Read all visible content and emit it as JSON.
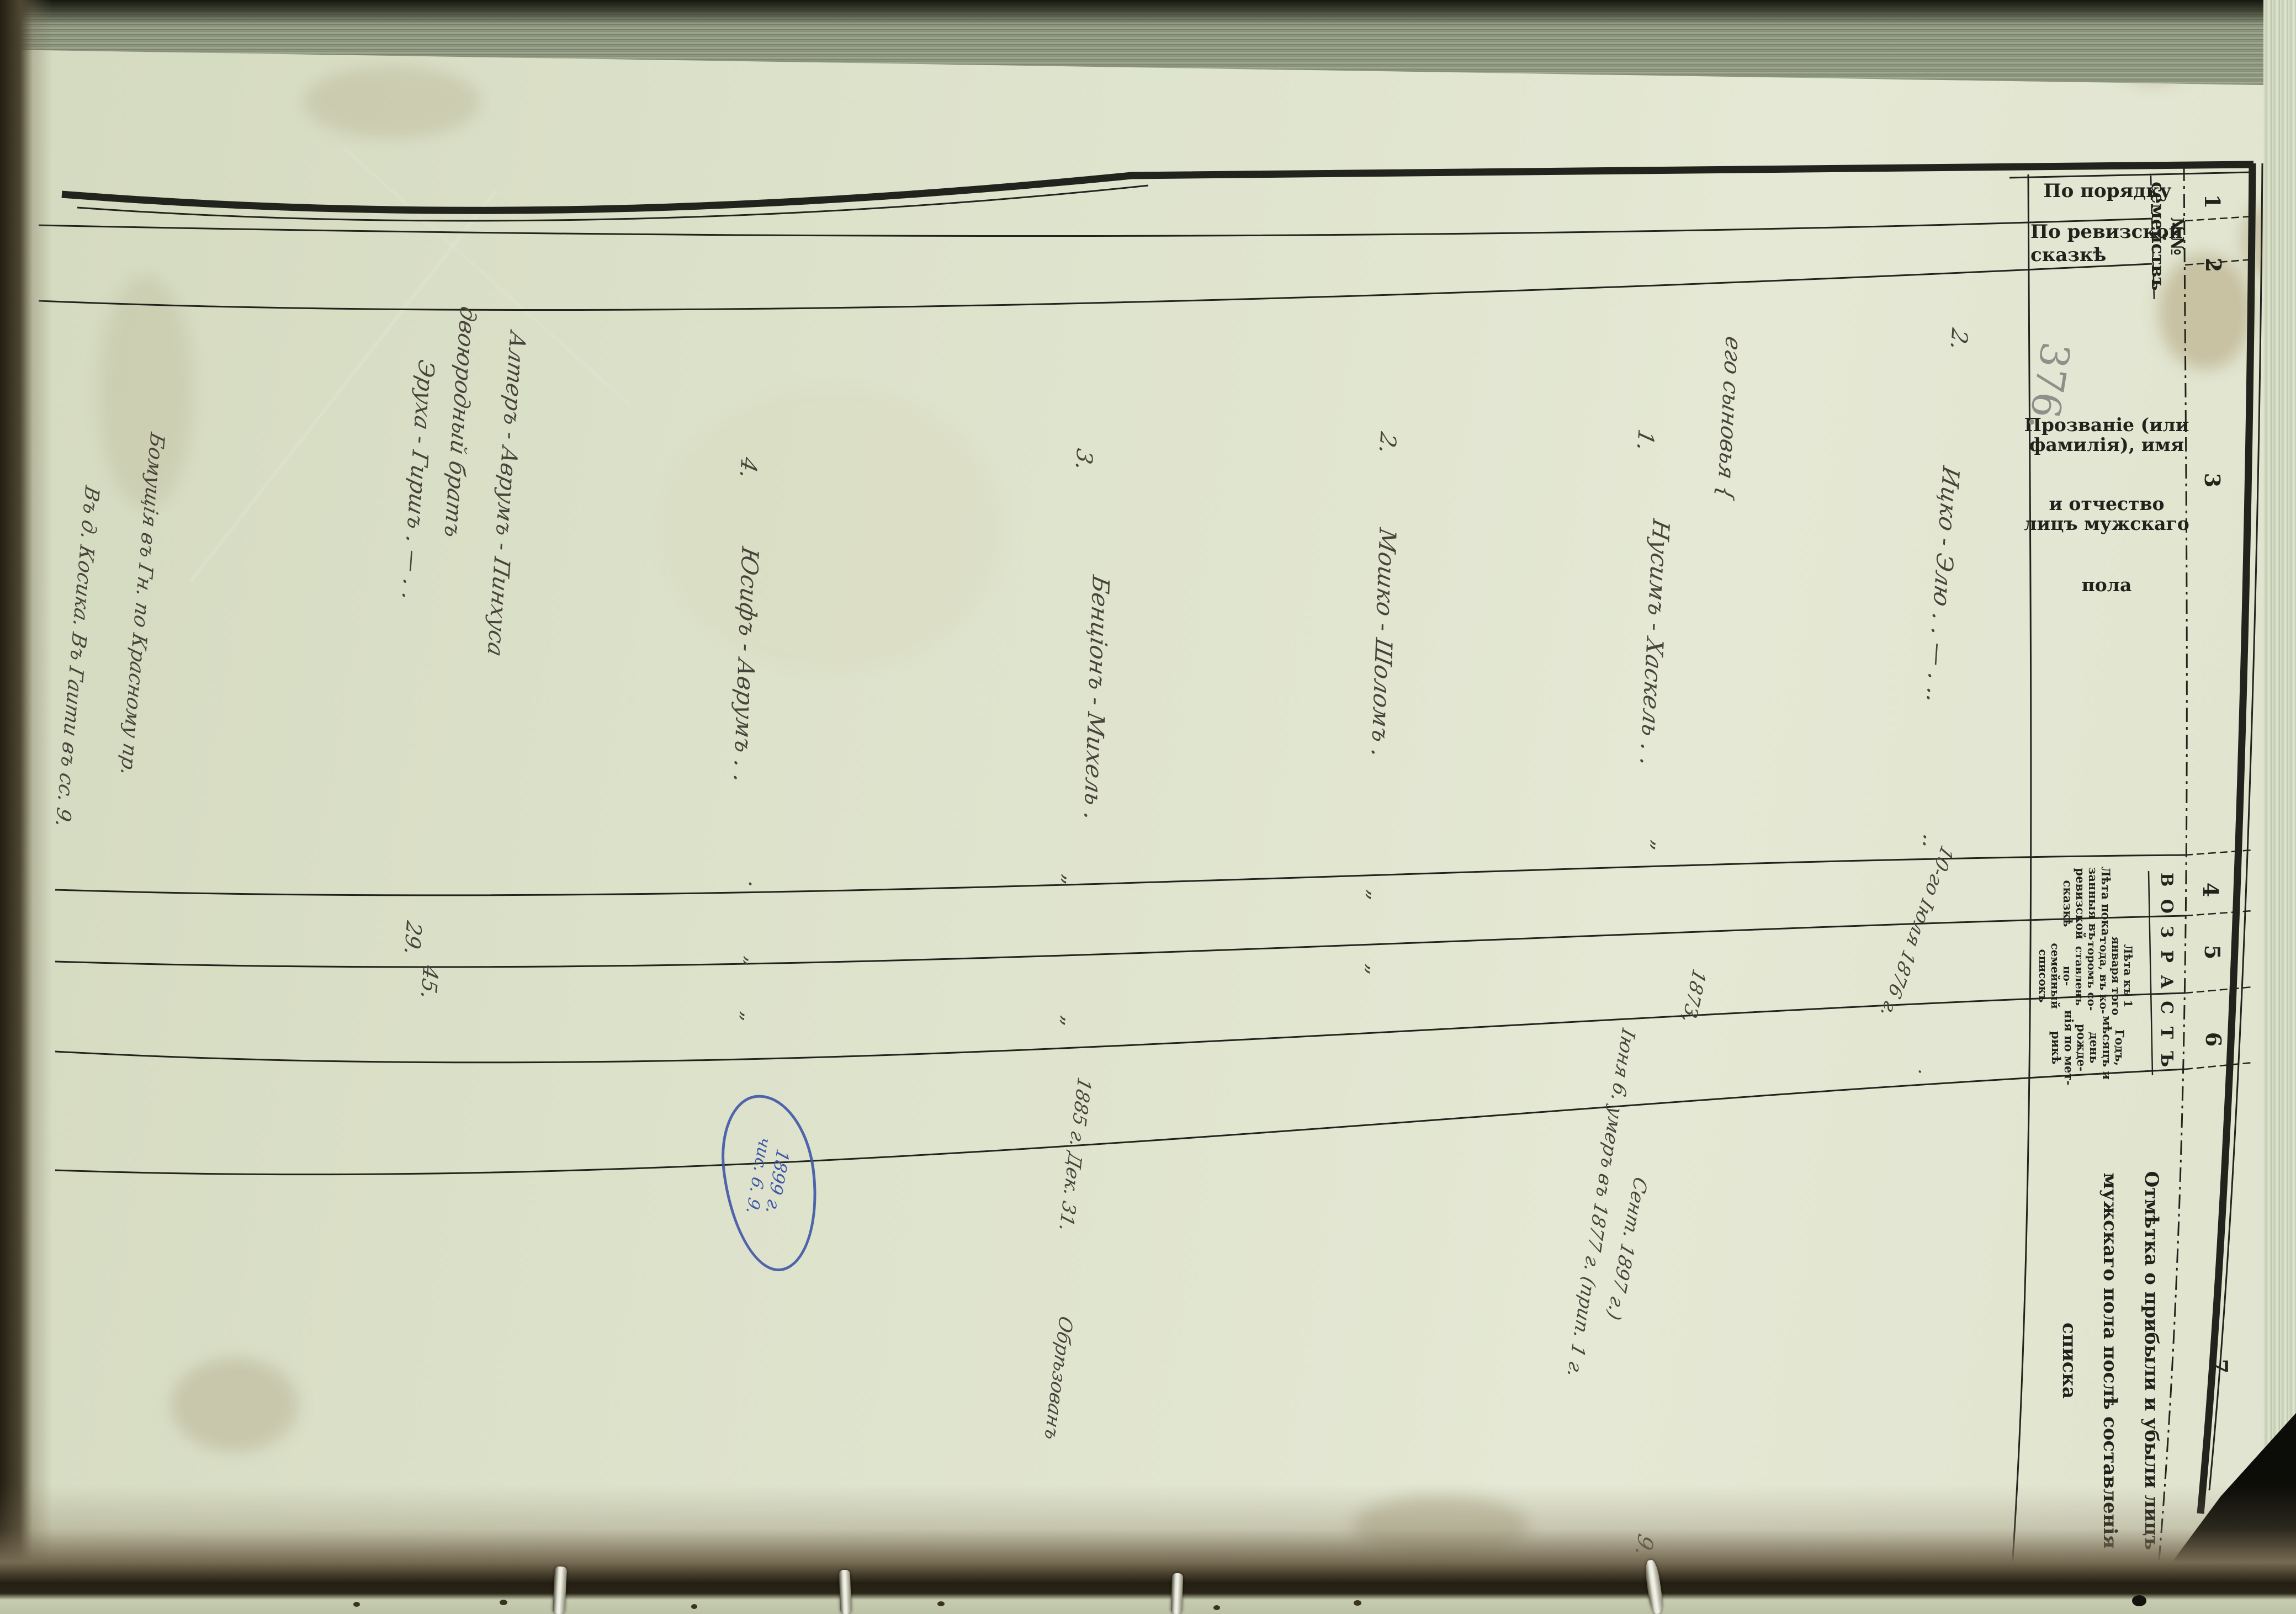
{
  "document": {
    "type": "Ревизская сказка / посемейный списокъ (scanned ledger page, rotated 90°)",
    "pencil_folio": "376."
  },
  "header": {
    "group_no_line1": "№№",
    "group_no_line2": "семействъ",
    "col1_label": "По порядку",
    "col2_label_line1": "По ревизской",
    "col2_label_line2": "сказкѣ",
    "col3_line1": "Прозваніе (или фамилія), имя",
    "col3_line2": "и отчество лицъ мужскаго",
    "col3_line3": "пола",
    "age_group": "В О З Р А С Т Ъ",
    "col4_lines": [
      "Лѣта пока-",
      "занныя въ",
      "ревизской",
      "сказкѣ"
    ],
    "col5_lines": [
      "Лѣта къ 1",
      "января того",
      "года, въ ко-",
      "торомъ со-",
      "ставленъ по-",
      "семейный",
      "списокъ"
    ],
    "col6_lines": [
      "Годъ,",
      "мѣсяцъ и",
      "день рожде-",
      "нія по мет-",
      "рикѣ"
    ],
    "col7_line1": "Отмѣтка о прибыли и убыли лицъ",
    "col7_line2": "мужскаго пола послѣ составленія",
    "col7_line3": "списка",
    "column_numbers": [
      "1",
      "2",
      "3",
      "4",
      "5",
      "6",
      "7"
    ]
  },
  "rows": [
    {
      "no": "2.",
      "name": "Ицко - Элю .  .   —  .  ..",
      "marks": "..",
      "birth_note": "10-го Іюля 1876 г.",
      "dot": "."
    },
    {
      "name": "его сыновья {"
    },
    {
      "no": "1.",
      "name": "Нусимъ - Хаскель . .",
      "ditto": "„",
      "year": "1873,",
      "death_note": "Іюня 6. умеръ въ 1877 г. (прип. 1 г.",
      "sent_note": "Сент. 1897 г.)"
    },
    {
      "no": "2.",
      "name": "Мошко - Шоломъ .",
      "ditto1": "„",
      "ditto2": "„"
    },
    {
      "no": "3.",
      "name": "Бенціонъ - Михель .",
      "ditto1": "„",
      "ditto2": "„",
      "birth": "1885 г. Дек. 31.",
      "note": "Обрѣзованъ"
    },
    {
      "no": "4.",
      "name": "Юсифъ - Аврумъ . .",
      "dot": ".",
      "ditto1": "„",
      "ditto2": "„"
    },
    {
      "line1": "Алтеръ - Аврумъ - Пинхуса",
      "line2": "двоюродный братъ",
      "line3": "Эруха - Гиршъ .  —  . .",
      "age_revision": "29.",
      "age_current": "45."
    }
  ],
  "annotations": {
    "margin_line1": "Бомущія въ Гн. по Красному пр.",
    "margin_line2": "Въ д. Косика. Въ Гаити въ сс. 9.",
    "stray_mark": "9.",
    "blue_oval_line1": "1899 г.",
    "blue_oval_line2": "чис. 6. 9."
  },
  "colors": {
    "paper": "#dde2cb",
    "ink_print": "#21221b",
    "ink_hand": "#48443b",
    "pencil": "#8f9089",
    "blue_ink": "#3f57a7",
    "binding_dark": "#1f1b12"
  }
}
